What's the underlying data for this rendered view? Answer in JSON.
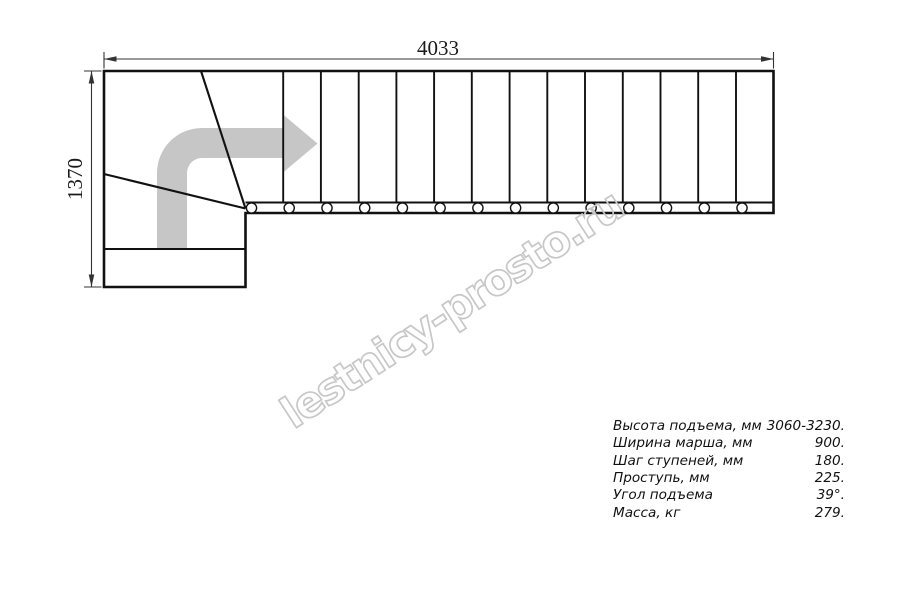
{
  "title": "L-shaped staircase plan drawing",
  "drawing": {
    "width_dimension": "4033",
    "height_dimension": "1370",
    "straight_steps": 13,
    "balusters": 14,
    "winder_steps": 3,
    "step_spacing_px": 37.73,
    "line_color": "#111111",
    "dimension_color": "#333333",
    "arrow_color": "#c6c6c6"
  },
  "specs": {
    "rows": [
      {
        "label": "Высота подъема, мм",
        "value": "3060-3230."
      },
      {
        "label": "Ширина марша, мм",
        "value": "900."
      },
      {
        "label": "Шаг ступеней, мм",
        "value": "180."
      },
      {
        "label": "Проступь, мм",
        "value": "225."
      },
      {
        "label": "Угол подъема",
        "value": "39°."
      },
      {
        "label": "Масса, кг",
        "value": "279."
      }
    ]
  },
  "watermark": {
    "text": "lestnicy-prosto.ru",
    "color": "#c7c7c7"
  }
}
